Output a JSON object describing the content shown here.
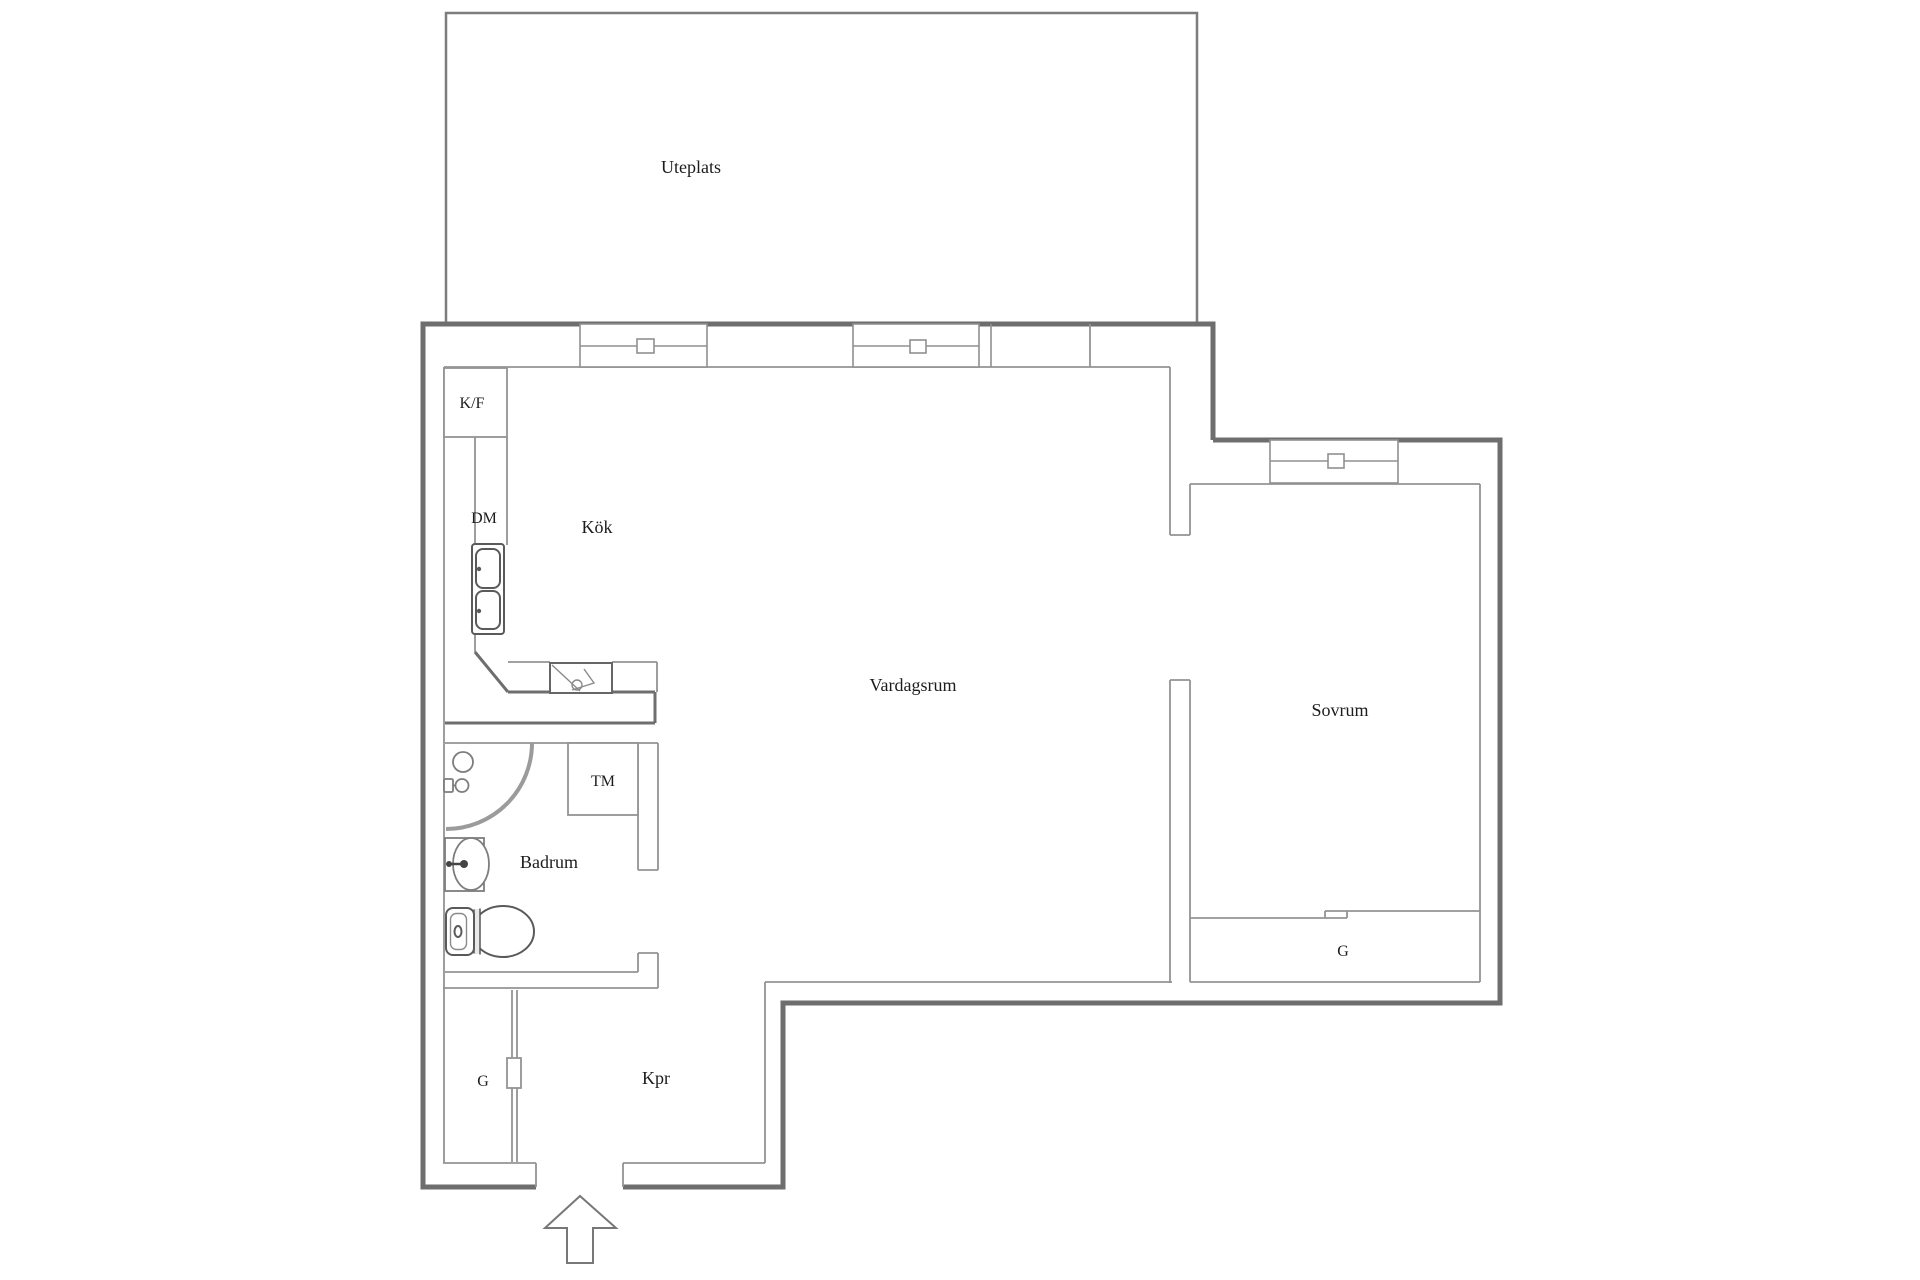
{
  "floorplan": {
    "rooms": {
      "uteplats": "Uteplats",
      "kok": "Kök",
      "vardagsrum": "Vardagsrum",
      "sovrum": "Sovrum",
      "badrum": "Badrum",
      "kpr": "Kpr"
    },
    "fixtures": {
      "fridge_freezer": "K/F",
      "dishwasher": "DM",
      "washing_machine": "TM",
      "wardrobe_bedroom": "G",
      "wardrobe_hall": "G"
    },
    "colors": {
      "exterior_wall": "#6e6e6e",
      "interior_line": "#949494",
      "label": "#1c1c1c",
      "background": "#ffffff"
    }
  }
}
